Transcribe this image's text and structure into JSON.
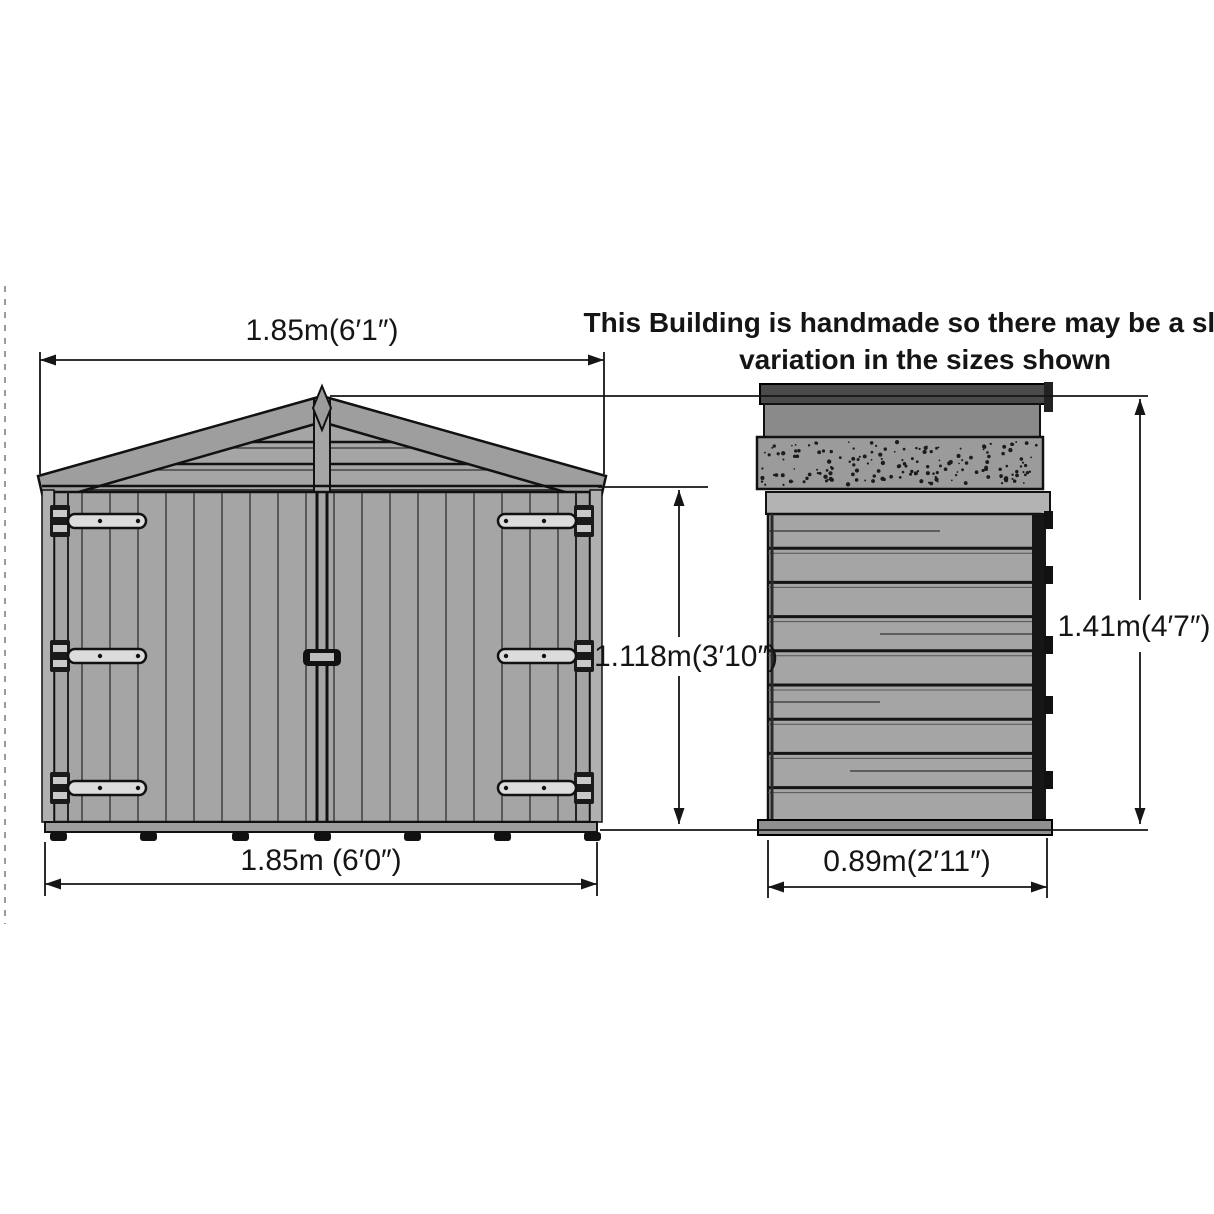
{
  "note": {
    "line1": "This Building is handmade so there may be a slight",
    "line2": "variation in the sizes shown"
  },
  "dimensions": {
    "front_width_overall": "1.85m(6′1″)",
    "front_width_base": "1.85m (6′0″)",
    "door_height": "1.118m(3′10″)",
    "overall_height": "1.41m(4′7″)",
    "side_depth": "0.89m(2′11″)"
  },
  "colors": {
    "outline": "#151515",
    "cladding": "#a5a5a5",
    "roof_cap": "#4a4a4a",
    "roof_fascia": "#8a8a8a",
    "felt": "#9b9b9b",
    "trim": "#b3b3b3",
    "background": "#ffffff"
  }
}
